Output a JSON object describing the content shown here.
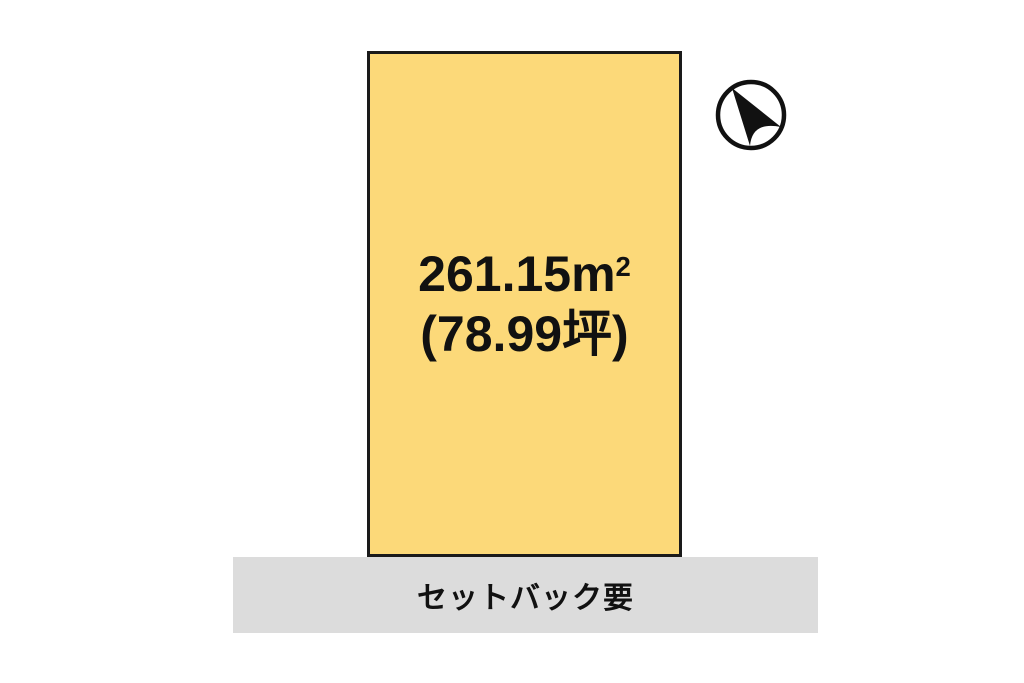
{
  "diagram": {
    "type": "land-plot-site-plan"
  },
  "plot": {
    "area_display": "261.15㎡",
    "area_value": "261.15m",
    "area_sup": "2",
    "area_tsubo": "(78.99坪)",
    "fill_color": "#FCD979",
    "border_color": "#1A1A1A"
  },
  "road": {
    "label": "セットバック要",
    "fill_color": "#DCDCDC"
  },
  "compass": {
    "icon": "north-arrow",
    "circle_color": "#111111",
    "arrow_color": "#111111"
  }
}
